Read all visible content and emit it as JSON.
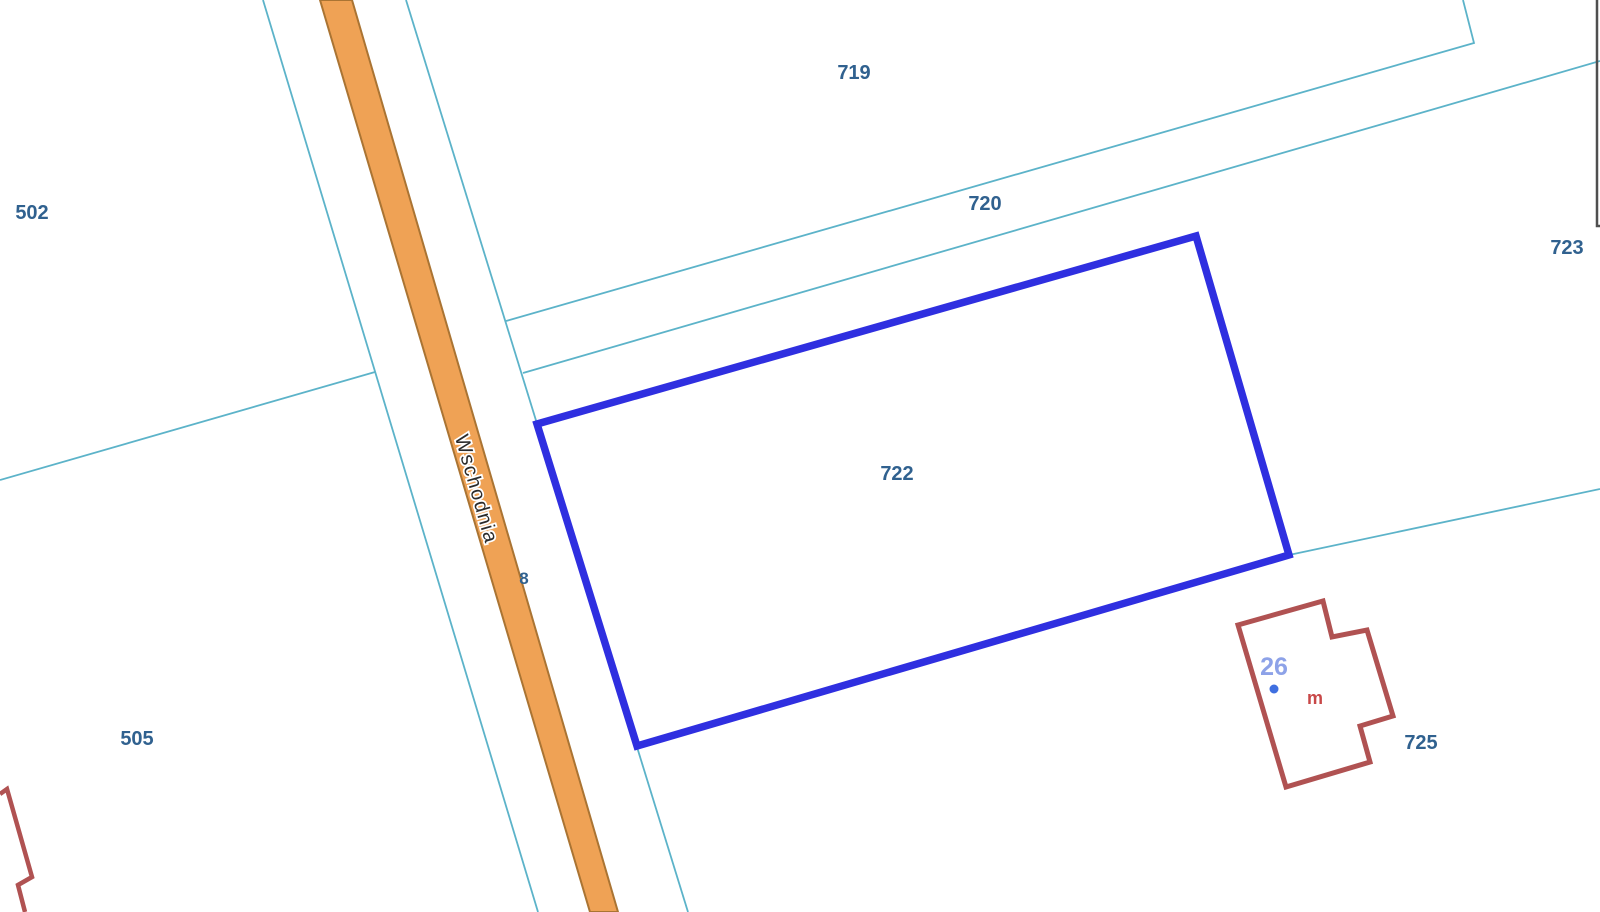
{
  "map": {
    "street": {
      "label": "Wschodnia"
    },
    "parcels": {
      "p719": {
        "label": "719"
      },
      "p720": {
        "label": "720"
      },
      "p722": {
        "label": "722",
        "highlighted": true
      },
      "p723": {
        "label": "723"
      },
      "p725": {
        "label": "725"
      },
      "p502": {
        "label": "502"
      },
      "p505": {
        "label": "505"
      },
      "p8_partial": {
        "label": "8"
      }
    },
    "building": {
      "house_number": "26",
      "type_label": "m"
    }
  },
  "colors": {
    "selection_blue": "#2f2fe0",
    "boundary_teal": "#5cb3c9",
    "road_fill": "#efa255",
    "road_border": "#aa7433",
    "building_outline_red": "#b05252",
    "parcel_label_blue": "#30618f",
    "house_number_blue": "#8da2e8",
    "building_type_red": "#c84848",
    "frame_gray": "#4f4f4f",
    "street_text": "#2b2b2b"
  }
}
